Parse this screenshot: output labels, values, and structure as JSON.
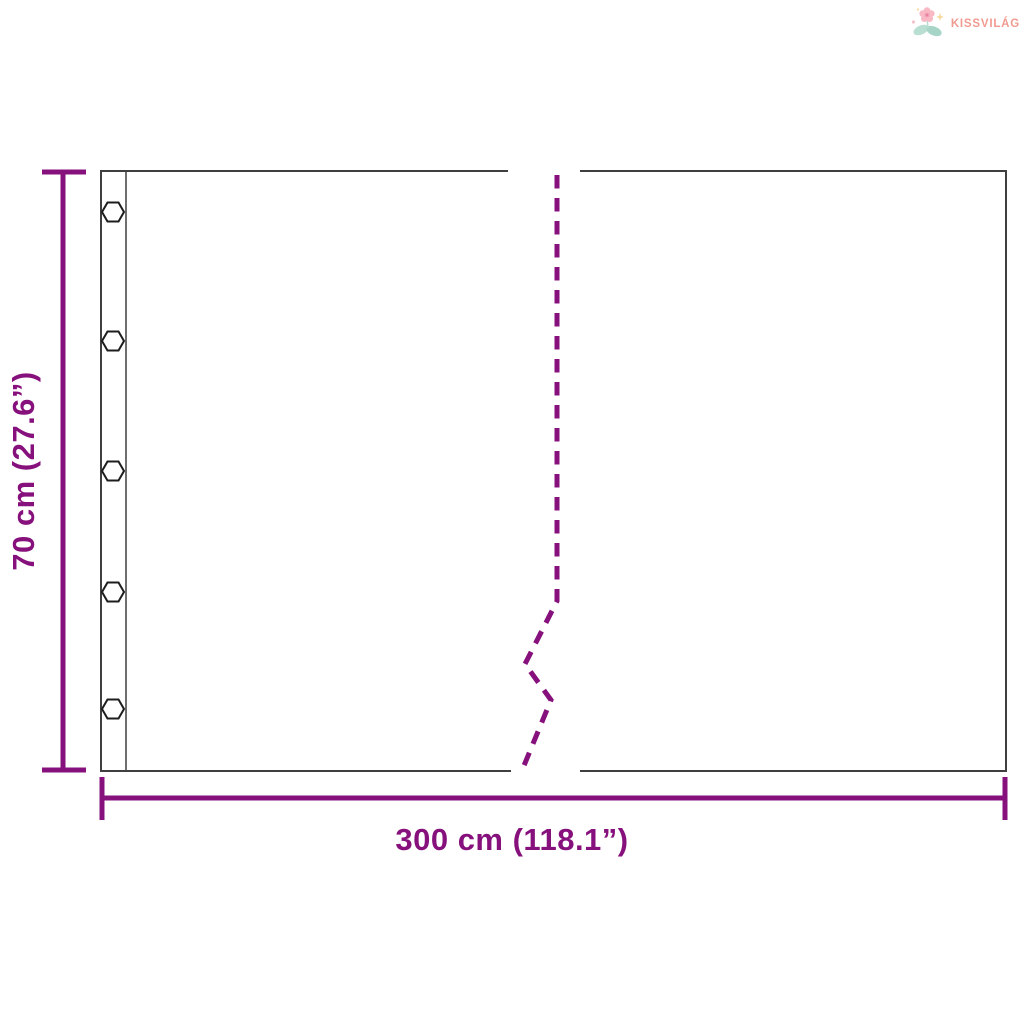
{
  "brand": {
    "name": "KISSVILÁG",
    "icon": "flower-icon"
  },
  "colors": {
    "accent": "#87117c",
    "panel_outline": "#3f3f3f",
    "hem_line": "#4a4a4a",
    "grommet_outline": "#1d1d1d",
    "logo_text": "#f19a90"
  },
  "diagram": {
    "height_label": "70 cm (27.6”)",
    "width_label": "300 cm (118.1”)",
    "grommets": {
      "count": 5,
      "shape": "hexagon"
    },
    "break_line_style": "dashed-zigzag"
  }
}
